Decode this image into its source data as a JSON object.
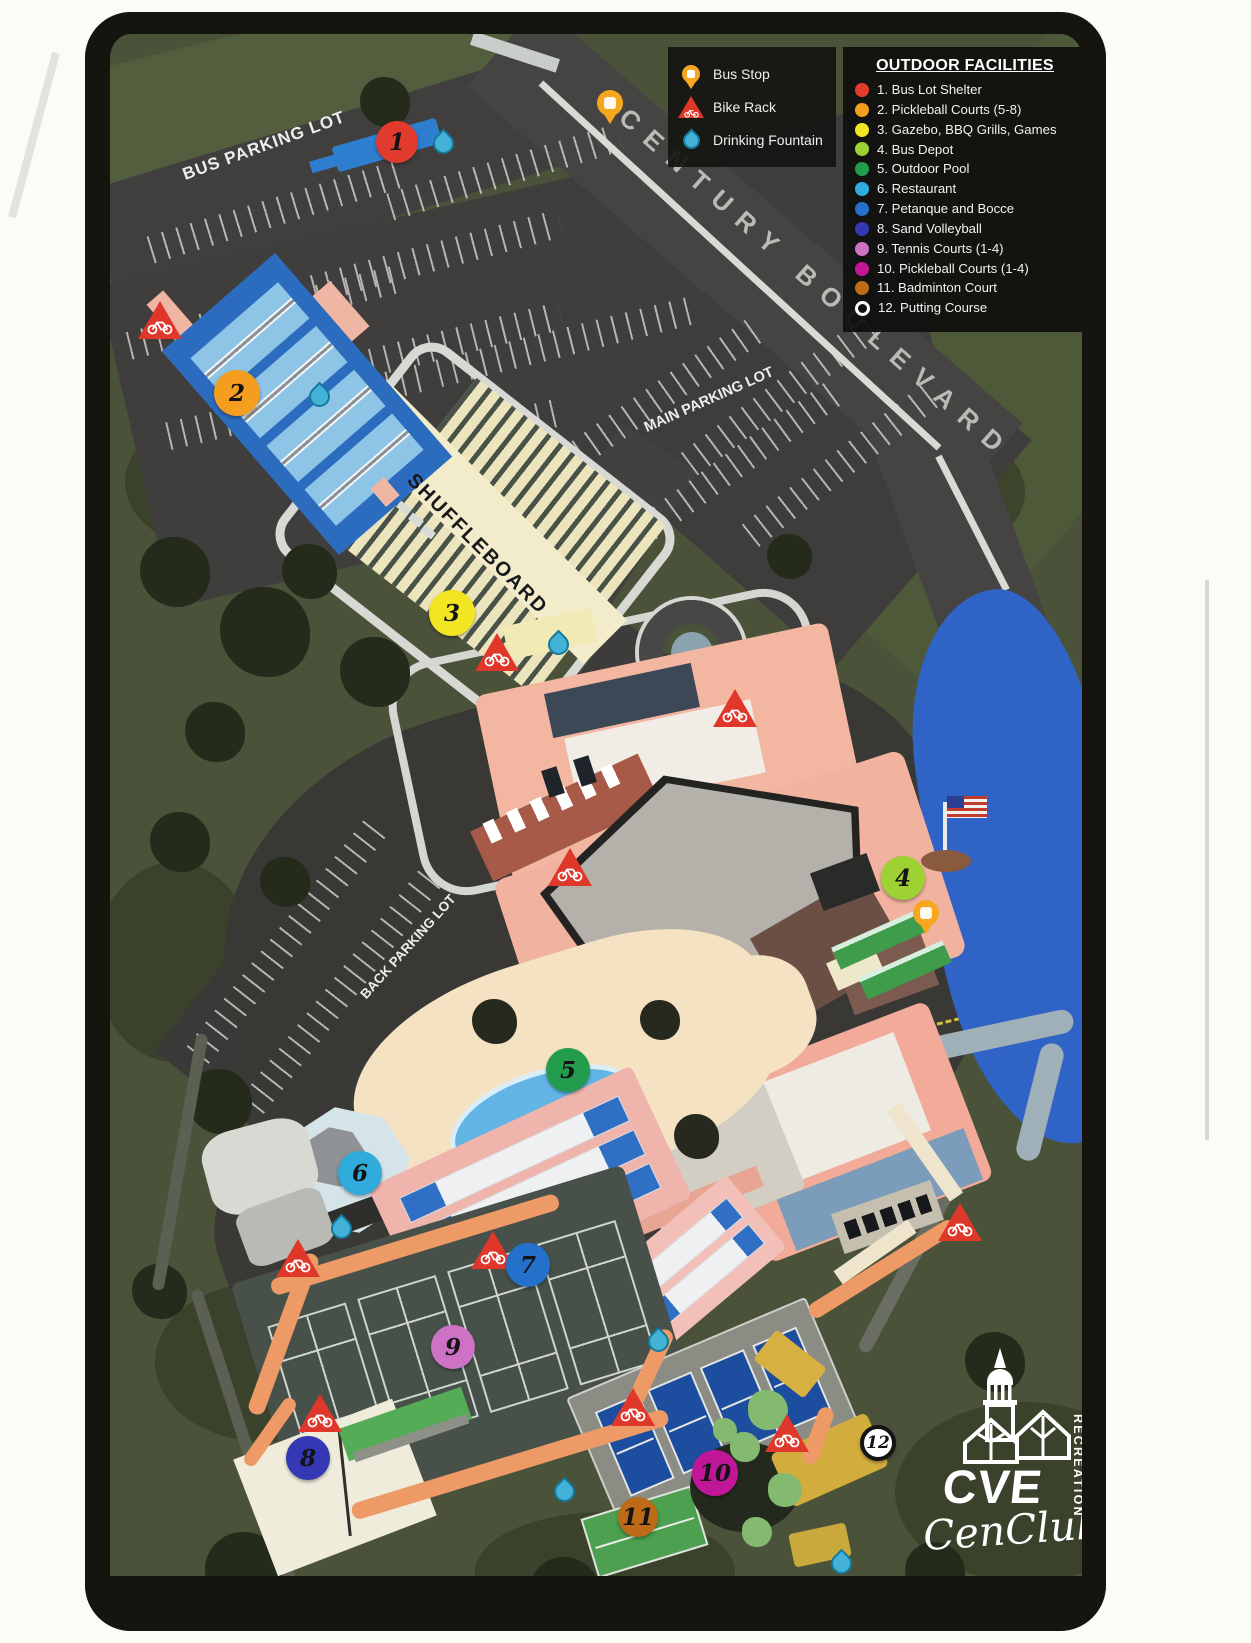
{
  "map_labels": {
    "bus_parking_lot": "BUS PARKING LOT",
    "century_boulevard": "CENTURY BOULEVARD",
    "main_parking_lot": "MAIN PARKING LOT",
    "shuffleboard": "SHUFFLEBOARD",
    "back_parking_lot": "BACK PARKING LOT"
  },
  "symbol_legend": {
    "items": [
      {
        "icon": "bus-stop-pin",
        "label": "Bus Stop"
      },
      {
        "icon": "bike-rack",
        "label": "Bike Rack"
      },
      {
        "icon": "drinking-fountain",
        "label": "Drinking Fountain"
      }
    ]
  },
  "outdoor_facilities": {
    "title": "OUTDOOR FACILITIES",
    "items": [
      {
        "label": "1. Bus Lot Shelter",
        "color": "#e23a2c"
      },
      {
        "label": "2. Pickleball Courts (5-8)",
        "color": "#f59d1e"
      },
      {
        "label": "3. Gazebo, BBQ Grills, Games",
        "color": "#f2e521"
      },
      {
        "label": "4. Bus Depot",
        "color": "#9ed133"
      },
      {
        "label": "5. Outdoor Pool",
        "color": "#239c4e"
      },
      {
        "label": "6. Restaurant",
        "color": "#2fabdc"
      },
      {
        "label": "7. Petanque and Bocce",
        "color": "#2471cb"
      },
      {
        "label": "8. Sand Volleyball",
        "color": "#3438b4"
      },
      {
        "label": "9. Tennis Courts (1-4)",
        "color": "#cd72c5"
      },
      {
        "label": "10. Pickleball Courts (1-4)",
        "color": "#c01799"
      },
      {
        "label": "11. Badminton Court",
        "color": "#bd6b17"
      },
      {
        "label": "12. Putting Course",
        "color": "#ffffff",
        "ring": true
      }
    ]
  },
  "markers": [
    {
      "num": "1",
      "x": 312,
      "y": 130,
      "color": "#e23a2c",
      "size": 42
    },
    {
      "num": "2",
      "x": 152,
      "y": 381,
      "color": "#f59d1e",
      "size": 46
    },
    {
      "num": "3",
      "x": 367,
      "y": 601,
      "color": "#f2e521",
      "size": 46
    },
    {
      "num": "4",
      "x": 818,
      "y": 866,
      "color": "#9ed133",
      "size": 44
    },
    {
      "num": "5",
      "x": 483,
      "y": 1058,
      "color": "#239c4e",
      "size": 44
    },
    {
      "num": "6",
      "x": 275,
      "y": 1161,
      "color": "#2fabdc",
      "size": 44
    },
    {
      "num": "7",
      "x": 443,
      "y": 1253,
      "color": "#2471cb",
      "size": 44
    },
    {
      "num": "8",
      "x": 223,
      "y": 1446,
      "color": "#3438b4",
      "size": 44
    },
    {
      "num": "9",
      "x": 368,
      "y": 1335,
      "color": "#cd72c5",
      "size": 44
    },
    {
      "num": "10",
      "x": 630,
      "y": 1461,
      "color": "#c01799",
      "size": 46
    },
    {
      "num": "11",
      "x": 553,
      "y": 1505,
      "color": "#bd6b17",
      "size": 40
    },
    {
      "num": "12",
      "x": 793,
      "y": 1431,
      "color": "#ffffff",
      "size": 36,
      "ring": true
    }
  ],
  "poi": {
    "bike_racks": [
      {
        "x": 75,
        "y": 308
      },
      {
        "x": 412,
        "y": 640
      },
      {
        "x": 650,
        "y": 696
      },
      {
        "x": 485,
        "y": 855
      },
      {
        "x": 213,
        "y": 1246
      },
      {
        "x": 408,
        "y": 1238
      },
      {
        "x": 235,
        "y": 1401
      },
      {
        "x": 548,
        "y": 1395
      },
      {
        "x": 702,
        "y": 1421
      },
      {
        "x": 875,
        "y": 1210
      }
    ],
    "drinking_fountains": [
      {
        "x": 357,
        "y": 130
      },
      {
        "x": 233,
        "y": 383
      },
      {
        "x": 472,
        "y": 631
      },
      {
        "x": 255,
        "y": 1215
      },
      {
        "x": 572,
        "y": 1328
      },
      {
        "x": 478,
        "y": 1478
      },
      {
        "x": 755,
        "y": 1550
      }
    ],
    "bus_stops": [
      {
        "x": 525,
        "y": 96
      },
      {
        "x": 841,
        "y": 906
      }
    ]
  },
  "logo": {
    "acronym": "CVE",
    "division": "RECREATION",
    "script_name": "CenClub"
  }
}
